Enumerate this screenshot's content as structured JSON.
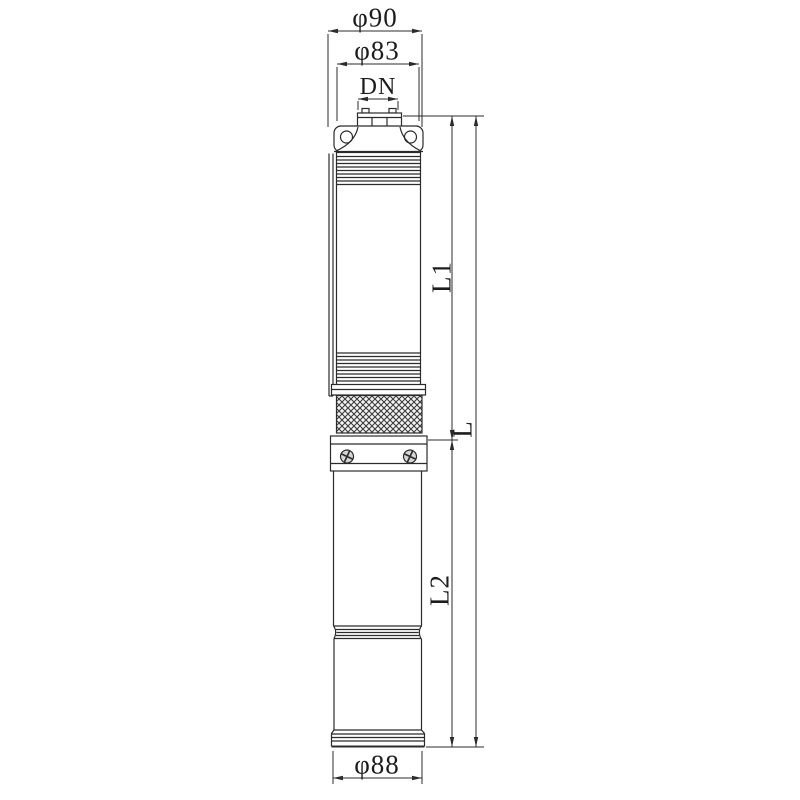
{
  "labels": {
    "top_outer_diameter": "φ90",
    "body_diameter": "φ83",
    "outlet": "DN",
    "pump_section_length": "L1",
    "total_length": "L",
    "motor_section_length": "L2",
    "bottom_diameter": "φ88"
  },
  "colors": {
    "line": "#2b2b2b",
    "text": "#1c1c1c",
    "background": "#ffffff"
  }
}
